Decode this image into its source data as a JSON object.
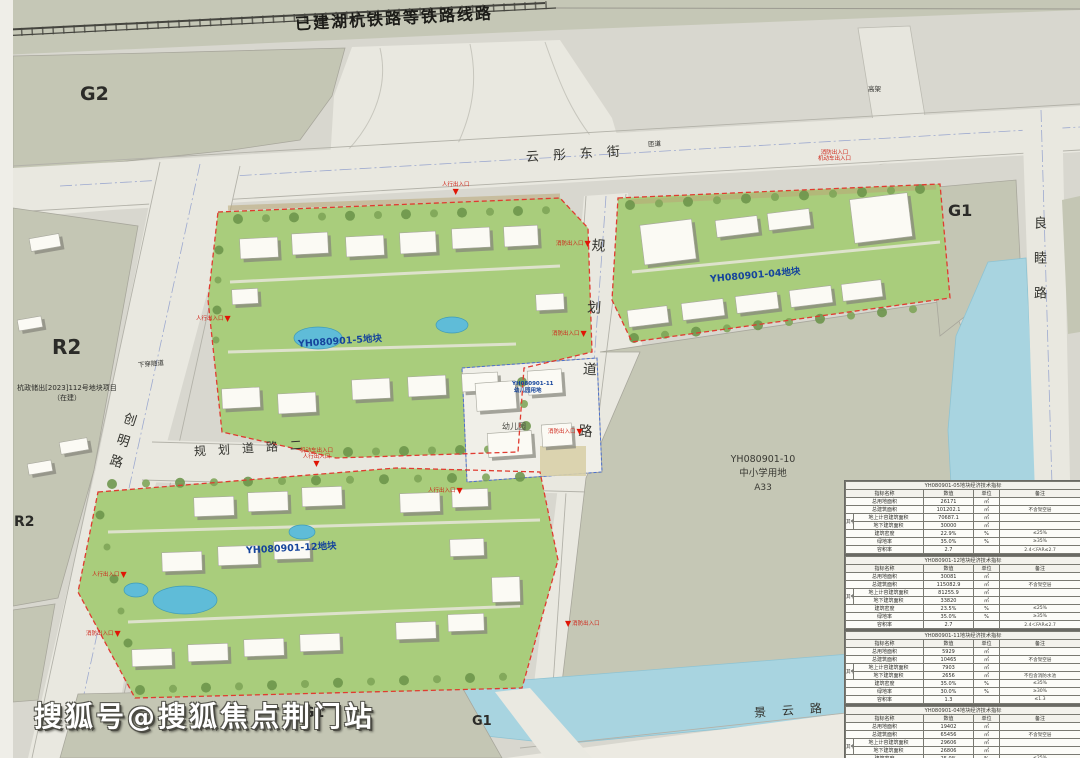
{
  "watermark": "搜狐号@搜狐焦点荆门站",
  "railway": {
    "label": "已建湖杭铁路等铁路线路"
  },
  "zones": {
    "g2": "G2",
    "r2_upper": "R2",
    "r2_lower": "R2",
    "r2_project_line1": "杭政储出[2023]112号地块项目",
    "r2_project_line2": "（在建）",
    "g1_right": "G1",
    "g1_bottom_left": "G1",
    "g1_bottom_mid": "G1"
  },
  "roads": {
    "yuntong_east": "云彤东街",
    "liangmu": "良睦路",
    "chuangming": "创明路",
    "planned_vertical": "规划道路",
    "planned_2": "规划道路二",
    "jingyun": "景云路",
    "underpass": "下穿隧道",
    "ramp": "匝道",
    "elevated": "高架"
  },
  "parcels": {
    "p5": "YH080901-5地块",
    "p04": "YH080901-04地块",
    "p12": "YH080901-12地块",
    "p11_code": "YH080901-11",
    "p11_use": "幼儿园用地",
    "kindergarten": "幼儿园",
    "school_code": "YH080901-10",
    "school_use": "中小学用地",
    "school_zone": "A33"
  },
  "entrances": {
    "pedestrian": "人行出入口",
    "fire": "消防出入口",
    "vehicle": "机动车出入口"
  },
  "icons": {
    "entrance_marker": "▼"
  },
  "tables": [
    {
      "title": "YH080901-05地块经济技术指标",
      "headers": [
        "指标名称",
        "数值",
        "单位",
        "备注"
      ],
      "group_label": "其中",
      "rows": [
        [
          "总用地面积",
          "26171",
          "㎡",
          ""
        ],
        [
          "总建筑面积",
          "101202.1",
          "㎡",
          "不含架空层"
        ],
        [
          "地上计容建筑面积",
          "70687.1",
          "㎡",
          ""
        ],
        [
          "地下建筑面积",
          "30000",
          "㎡",
          ""
        ],
        [
          "建筑密度",
          "22.9%",
          "%",
          "≤25%"
        ],
        [
          "绿地率",
          "35.0%",
          "%",
          "≥35%"
        ],
        [
          "容积率",
          "2.7",
          "",
          "2.4＜FAR≤2.7"
        ]
      ]
    },
    {
      "title": "YH080901-12地块经济技术指标",
      "headers": [
        "指标名称",
        "数值",
        "单位",
        "备注"
      ],
      "group_label": "其中",
      "rows": [
        [
          "总用地面积",
          "30081",
          "㎡",
          ""
        ],
        [
          "总建筑面积",
          "115082.9",
          "㎡",
          "不含架空层"
        ],
        [
          "地上计容建筑面积",
          "81255.9",
          "㎡",
          ""
        ],
        [
          "地下建筑面积",
          "33820",
          "㎡",
          ""
        ],
        [
          "建筑密度",
          "23.5%",
          "%",
          "≤25%"
        ],
        [
          "绿地率",
          "35.0%",
          "%",
          "≥35%"
        ],
        [
          "容积率",
          "2.7",
          "",
          "2.4＜FAR≤2.7"
        ]
      ]
    },
    {
      "title": "YH080901-11地块经济技术指标",
      "headers": [
        "指标名称",
        "数值",
        "单位",
        "备注"
      ],
      "group_label": "其中",
      "rows": [
        [
          "总用地面积",
          "5929",
          "㎡",
          ""
        ],
        [
          "总建筑面积",
          "10465",
          "㎡",
          "不含架空层"
        ],
        [
          "地上计容建筑面积",
          "7903",
          "㎡",
          ""
        ],
        [
          "地下建筑面积",
          "2656",
          "㎡",
          "不包含消防水池"
        ],
        [
          "建筑密度",
          "35.0%",
          "%",
          "≤35%"
        ],
        [
          "绿地率",
          "30.0%",
          "%",
          "≥30%"
        ],
        [
          "容积率",
          "1.3",
          "",
          "≤1.3"
        ]
      ]
    },
    {
      "title": "YH080901-04地块经济技术指标",
      "headers": [
        "指标名称",
        "数值",
        "单位",
        "备注"
      ],
      "group_label": "其中",
      "rows": [
        [
          "总用地面积",
          "19402",
          "㎡",
          ""
        ],
        [
          "总建筑面积",
          "65456",
          "㎡",
          "不含架空层"
        ],
        [
          "地上计容建筑面积",
          "29606",
          "㎡",
          ""
        ],
        [
          "地下建筑面积",
          "26806",
          "㎡",
          ""
        ],
        [
          "建筑密度",
          "25.0%",
          "%",
          "≤25%"
        ],
        [
          "绿地率",
          "35.0%",
          "%",
          "≥35%"
        ],
        [
          "容积率",
          "2.5",
          "",
          "≤2.5"
        ]
      ]
    }
  ]
}
